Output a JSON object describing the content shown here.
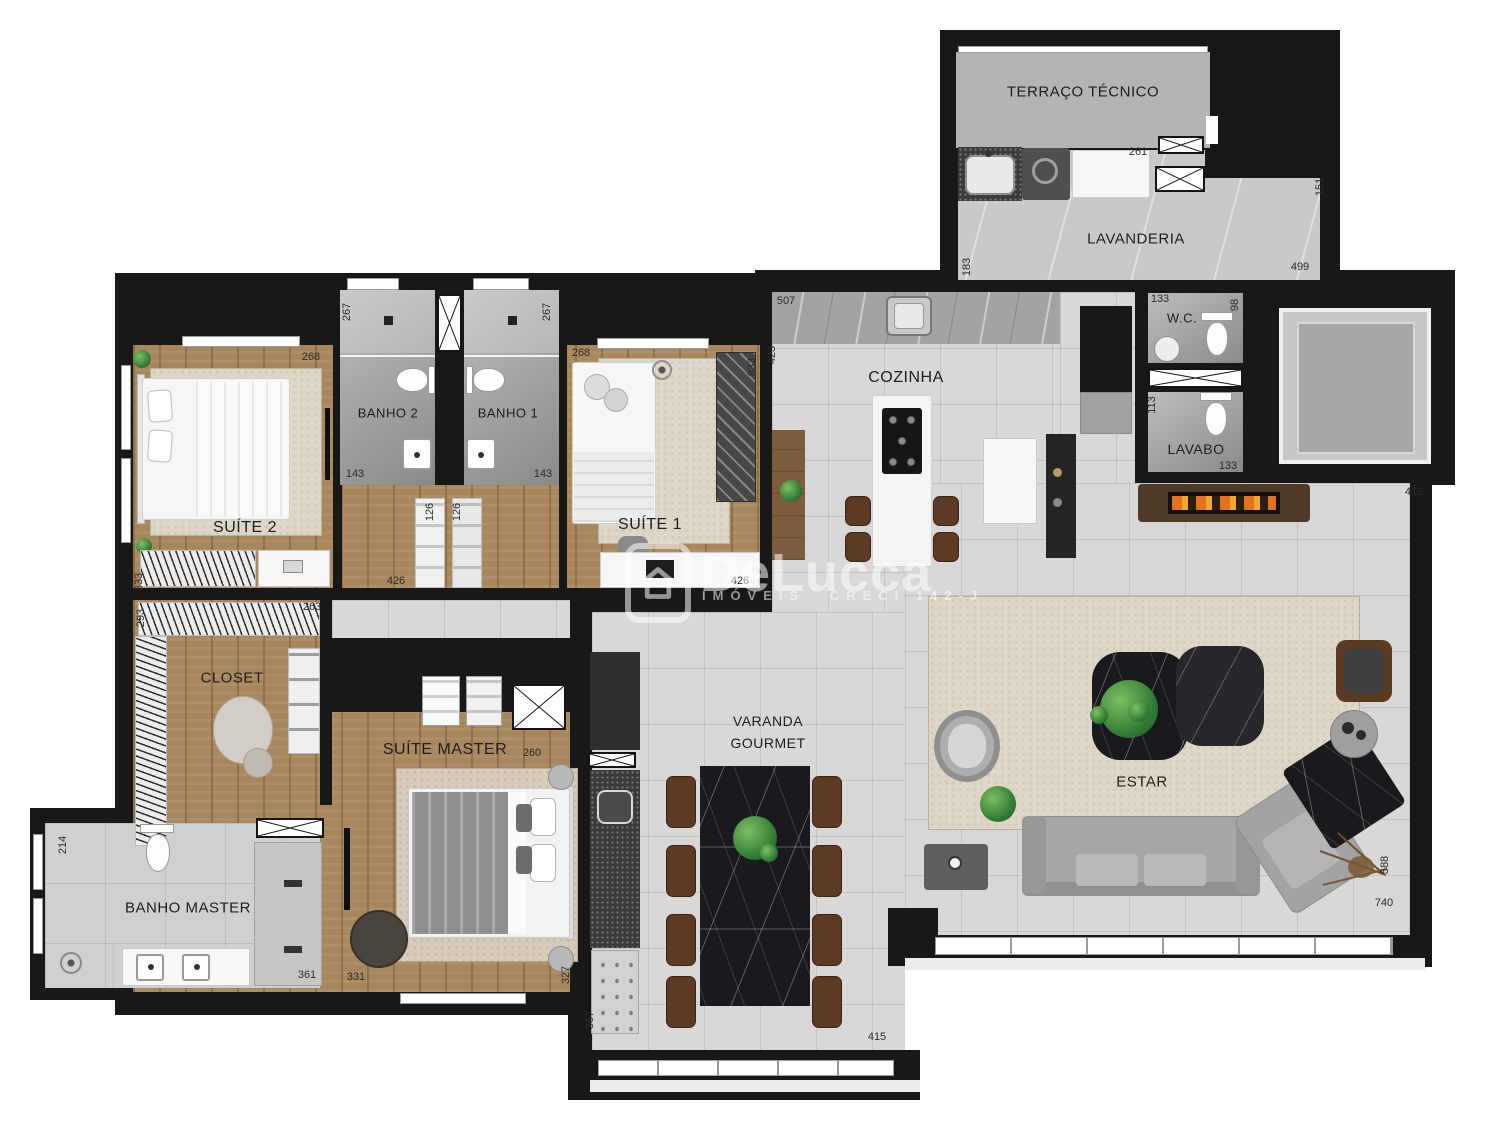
{
  "rooms": {
    "terraco": "TERRAÇO TÉCNICO",
    "lavanderia": "LAVANDERIA",
    "wc": "W.C.",
    "lavabo": "LAVABO",
    "cozinha": "COZINHA",
    "banho2": "BANHO 2",
    "banho1": "BANHO 1",
    "suite2": "SUÍTE 2",
    "suite1": "SUÍTE 1",
    "closet": "CLOSET",
    "suite_master": "SUÍTE MASTER",
    "banho_master": "BANHO MASTER",
    "varanda_line1": "VARANDA",
    "varanda_line2": "GOURMET",
    "estar": "ESTAR"
  },
  "watermark": {
    "brand_first": "De",
    "brand_second": "Lucca",
    "sub_left": "IMÓVEIS",
    "sub_right": "CRECI 142-J"
  },
  "dimensions_cm": [
    {
      "t": "261",
      "x": 1138,
      "y": 152,
      "v": 0
    },
    {
      "t": "499",
      "x": 1300,
      "y": 267,
      "v": 0
    },
    {
      "t": "507",
      "x": 786,
      "y": 301,
      "v": 0
    },
    {
      "t": "133",
      "x": 1160,
      "y": 299,
      "v": 0
    },
    {
      "t": "133",
      "x": 1228,
      "y": 466,
      "v": 0
    },
    {
      "t": "412",
      "x": 1414,
      "y": 492,
      "v": 0
    },
    {
      "t": "268",
      "x": 311,
      "y": 357,
      "v": 0
    },
    {
      "t": "268",
      "x": 581,
      "y": 353,
      "v": 0
    },
    {
      "t": "143",
      "x": 355,
      "y": 474,
      "v": 0
    },
    {
      "t": "143",
      "x": 543,
      "y": 474,
      "v": 0
    },
    {
      "t": "426",
      "x": 396,
      "y": 581,
      "v": 0
    },
    {
      "t": "426",
      "x": 740,
      "y": 581,
      "v": 0
    },
    {
      "t": "263",
      "x": 312,
      "y": 607,
      "v": 0
    },
    {
      "t": "260",
      "x": 532,
      "y": 753,
      "v": 0
    },
    {
      "t": "361",
      "x": 307,
      "y": 975,
      "v": 0
    },
    {
      "t": "331",
      "x": 356,
      "y": 977,
      "v": 0
    },
    {
      "t": "415",
      "x": 877,
      "y": 1037,
      "v": 0
    },
    {
      "t": "740",
      "x": 1384,
      "y": 903,
      "v": 0
    },
    {
      "t": "151",
      "x": 1320,
      "y": 187,
      "v": 1
    },
    {
      "t": "183",
      "x": 967,
      "y": 267,
      "v": 1
    },
    {
      "t": "423",
      "x": 772,
      "y": 355,
      "v": 1
    },
    {
      "t": "98",
      "x": 1235,
      "y": 305,
      "v": 1
    },
    {
      "t": "113",
      "x": 1152,
      "y": 405,
      "v": 1
    },
    {
      "t": "267",
      "x": 347,
      "y": 312,
      "v": 1
    },
    {
      "t": "267",
      "x": 547,
      "y": 312,
      "v": 1
    },
    {
      "t": "833",
      "x": 752,
      "y": 367,
      "v": 1
    },
    {
      "t": "126",
      "x": 430,
      "y": 512,
      "v": 1
    },
    {
      "t": "126",
      "x": 457,
      "y": 512,
      "v": 1
    },
    {
      "t": "333",
      "x": 139,
      "y": 582,
      "v": 1
    },
    {
      "t": "293",
      "x": 141,
      "y": 618,
      "v": 1
    },
    {
      "t": "214",
      "x": 63,
      "y": 845,
      "v": 1
    },
    {
      "t": "327",
      "x": 566,
      "y": 975,
      "v": 1
    },
    {
      "t": "367",
      "x": 590,
      "y": 1020,
      "v": 1
    },
    {
      "t": "588",
      "x": 1385,
      "y": 865,
      "v": 1
    }
  ]
}
